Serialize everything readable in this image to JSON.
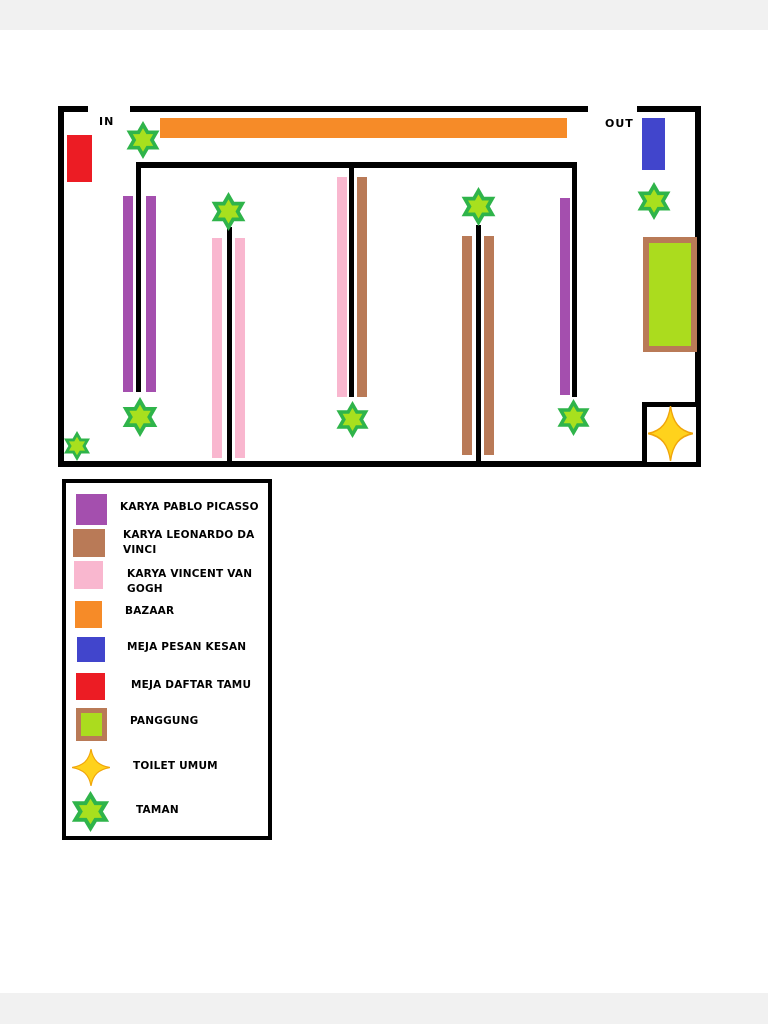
{
  "page": {
    "margin_color": "#f1f1f1"
  },
  "colors": {
    "wall": "#000000",
    "picasso": "#a44fae",
    "davinci": "#b97a57",
    "vangogh": "#f9b7cf",
    "bazaar": "#f68b28",
    "pesan_kesan": "#4145cc",
    "daftar_tamu": "#ec1c24",
    "panggung_fill": "#abdc1e",
    "panggung_border": "#b97a57",
    "star_green": "#2fb44a",
    "star_lime": "#a8e01e",
    "toilet_yellow": "#ffd21c",
    "toilet_edge": "#f0a50a",
    "white": "#ffffff"
  },
  "map": {
    "labels": {
      "in": "IN",
      "out": "OUT"
    },
    "label_pos": {
      "in": {
        "x": 99,
        "y": 115
      },
      "out": {
        "x": 605,
        "y": 117
      }
    },
    "walls": [
      {
        "x": 58,
        "y": 106,
        "w": 30,
        "h": 6
      },
      {
        "x": 130,
        "y": 106,
        "w": 458,
        "h": 6
      },
      {
        "x": 637,
        "y": 106,
        "w": 64,
        "h": 6
      },
      {
        "x": 58,
        "y": 106,
        "w": 6,
        "h": 361
      },
      {
        "x": 695,
        "y": 106,
        "w": 6,
        "h": 361
      },
      {
        "x": 58,
        "y": 461,
        "w": 643,
        "h": 6
      },
      {
        "x": 136,
        "y": 162,
        "w": 441,
        "h": 6
      },
      {
        "x": 136,
        "y": 162,
        "w": 5,
        "h": 230
      },
      {
        "x": 349,
        "y": 162,
        "w": 5,
        "h": 235
      },
      {
        "x": 572,
        "y": 162,
        "w": 5,
        "h": 235
      },
      {
        "x": 227,
        "y": 227,
        "w": 5,
        "h": 237
      },
      {
        "x": 476,
        "y": 225,
        "w": 5,
        "h": 239
      }
    ],
    "bars": [
      {
        "name": "picasso-artwork-panel",
        "color": "picasso",
        "x": 123,
        "y": 196,
        "w": 10,
        "h": 196
      },
      {
        "name": "picasso-artwork-panel",
        "color": "picasso",
        "x": 146,
        "y": 196,
        "w": 10,
        "h": 196
      },
      {
        "name": "picasso-artwork-panel",
        "color": "picasso",
        "x": 560,
        "y": 198,
        "w": 10,
        "h": 197
      },
      {
        "name": "vangogh-artwork-panel",
        "color": "vangogh",
        "x": 212,
        "y": 238,
        "w": 10,
        "h": 220
      },
      {
        "name": "vangogh-artwork-panel",
        "color": "vangogh",
        "x": 235,
        "y": 238,
        "w": 10,
        "h": 220
      },
      {
        "name": "vangogh-artwork-panel",
        "color": "vangogh",
        "x": 337,
        "y": 177,
        "w": 10,
        "h": 220
      },
      {
        "name": "davinci-artwork-panel",
        "color": "davinci",
        "x": 357,
        "y": 177,
        "w": 10,
        "h": 220
      },
      {
        "name": "davinci-artwork-panel",
        "color": "davinci",
        "x": 462,
        "y": 236,
        "w": 10,
        "h": 219
      },
      {
        "name": "davinci-artwork-panel",
        "color": "davinci",
        "x": 484,
        "y": 236,
        "w": 10,
        "h": 219
      }
    ],
    "rects": [
      {
        "name": "bazaar-stand",
        "color": "bazaar",
        "x": 160,
        "y": 118,
        "w": 407,
        "h": 20
      },
      {
        "name": "guest-registration-table",
        "color": "daftar_tamu",
        "x": 67,
        "y": 135,
        "w": 25,
        "h": 47
      },
      {
        "name": "impression-note-table",
        "color": "pesan_kesan",
        "x": 642,
        "y": 118,
        "w": 23,
        "h": 52
      },
      {
        "name": "stage-panggung",
        "color": "panggung_fill",
        "border": "panggung_border",
        "bw": 6,
        "x": 643,
        "y": 237,
        "w": 54,
        "h": 115
      },
      {
        "name": "toilet-room",
        "color": "white",
        "border": "wall",
        "bw": 5,
        "x": 642,
        "y": 402,
        "w": 59,
        "h": 65
      }
    ],
    "garden_stars": [
      {
        "x": 124,
        "y": 121,
        "s": 38
      },
      {
        "x": 209,
        "y": 192,
        "s": 39
      },
      {
        "x": 459,
        "y": 187,
        "s": 39
      },
      {
        "x": 635,
        "y": 182,
        "s": 38
      },
      {
        "x": 120,
        "y": 397,
        "s": 40
      },
      {
        "x": 334,
        "y": 401,
        "s": 37
      },
      {
        "x": 555,
        "y": 399,
        "s": 37
      },
      {
        "x": 62,
        "y": 431,
        "s": 30
      }
    ],
    "toilet_star": {
      "x": 648,
      "y": 406,
      "w": 45,
      "h": 55
    }
  },
  "legend": {
    "items": [
      {
        "icon": "rect",
        "color": "picasso",
        "label": "KARYA PABLO PICASSO",
        "sx": 76,
        "sy": 494,
        "sw": 31,
        "sh": 31,
        "lx": 120,
        "ly": 500
      },
      {
        "icon": "rect",
        "color": "davinci",
        "label": "KARYA LEONARDO DA VINCI",
        "sx": 73,
        "sy": 529,
        "sw": 32,
        "sh": 28,
        "lx": 123,
        "ly": 528
      },
      {
        "icon": "rect",
        "color": "vangogh",
        "label": "KARYA VINCENT VAN GOGH",
        "sx": 74,
        "sy": 561,
        "sw": 29,
        "sh": 28,
        "lx": 127,
        "ly": 567
      },
      {
        "icon": "rect",
        "color": "bazaar",
        "label": "BAZAAR",
        "sx": 75,
        "sy": 601,
        "sw": 27,
        "sh": 27,
        "lx": 125,
        "ly": 604
      },
      {
        "icon": "rect",
        "color": "pesan_kesan",
        "label": "MEJA PESAN KESAN",
        "sx": 77,
        "sy": 637,
        "sw": 28,
        "sh": 25,
        "lx": 127,
        "ly": 640
      },
      {
        "icon": "rect",
        "color": "daftar_tamu",
        "label": "MEJA DAFTAR TAMU",
        "sx": 76,
        "sy": 673,
        "sw": 29,
        "sh": 27,
        "lx": 131,
        "ly": 678
      },
      {
        "icon": "rect",
        "color": "panggung_fill",
        "border": "panggung_border",
        "bw": 5,
        "label": "PANGGUNG",
        "sx": 76,
        "sy": 708,
        "sw": 31,
        "sh": 33,
        "lx": 130,
        "ly": 714
      },
      {
        "icon": "star4",
        "label": "TOILET UMUM",
        "sx": 72,
        "sy": 749,
        "sw": 38,
        "sh": 37,
        "lx": 133,
        "ly": 759
      },
      {
        "icon": "star6",
        "label": "TAMAN",
        "sx": 69,
        "sy": 791,
        "sw": 43,
        "sh": 41,
        "lx": 136,
        "ly": 803
      }
    ]
  }
}
